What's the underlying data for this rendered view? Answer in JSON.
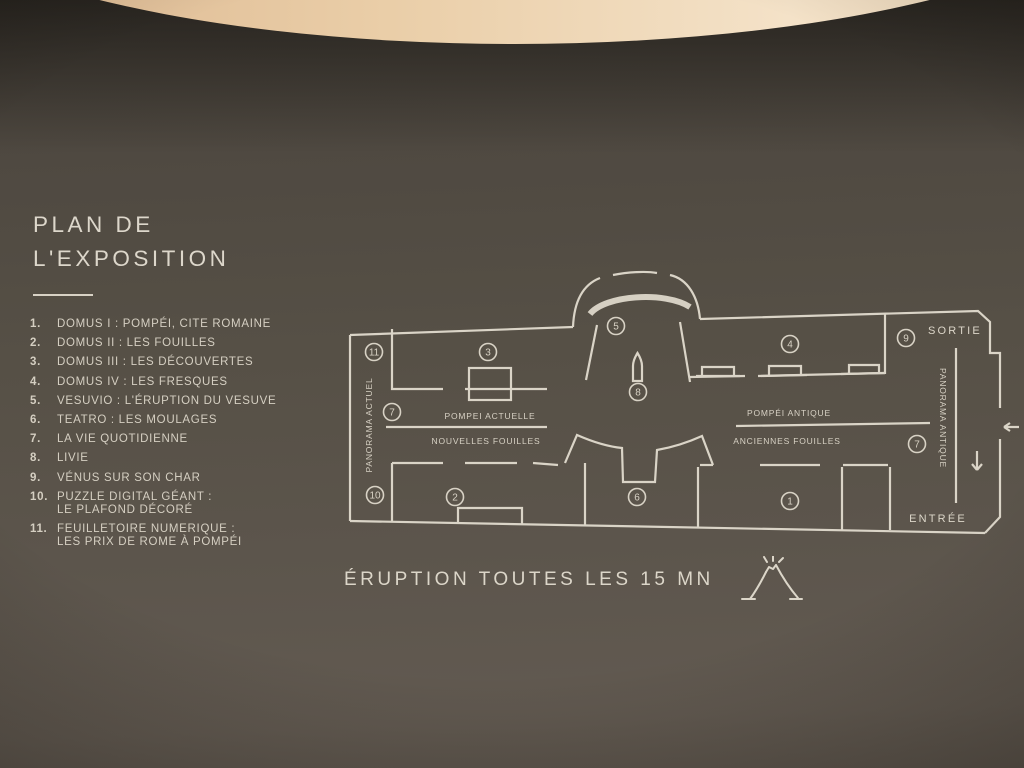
{
  "colors": {
    "wall": "#57504a",
    "text": "#d8d2c5",
    "ceiling": "#eed7ba",
    "line": "#dad4c7"
  },
  "title": {
    "line1": "PLAN DE",
    "line2": "L'EXPOSITION"
  },
  "legend": {
    "items": [
      {
        "num": "1.",
        "text": "DOMUS I : POMPÉI, CITE ROMAINE"
      },
      {
        "num": "2.",
        "text": "DOMUS II : LES FOUILLES"
      },
      {
        "num": "3.",
        "text": "DOMUS III : LES DÉCOUVERTES"
      },
      {
        "num": "4.",
        "text": "DOMUS IV : LES FRESQUES"
      },
      {
        "num": "5.",
        "text": "VESUVIO : L'ÉRUPTION DU VESUVE"
      },
      {
        "num": "6.",
        "text": "TEATRO : LES MOULAGES"
      },
      {
        "num": "7.",
        "text": "LA VIE QUOTIDIENNE"
      },
      {
        "num": "8.",
        "text": "LIVIE"
      },
      {
        "num": "9.",
        "text": "VÉNUS SUR SON CHAR"
      },
      {
        "num": "10.",
        "text": "PUZZLE DIGITAL GÉANT :",
        "text2": "LE PLAFOND DÉCORÉ"
      },
      {
        "num": "11.",
        "text": "FEUILLETOIRE NUMERIQUE :",
        "text2": "LES PRIX DE ROME À POMPÉI"
      }
    ]
  },
  "plan": {
    "markers": {
      "m1": "1",
      "m2": "2",
      "m3": "3",
      "m4": "4",
      "m5": "5",
      "m6": "6",
      "m7": "7",
      "m7b": "7",
      "m8": "8",
      "m9": "9",
      "m10": "10",
      "m11": "11"
    },
    "labels": {
      "panorama_actuel": "PANORAMA ACTUEL",
      "pompei_actuelle": "POMPEI ACTUELLE",
      "nouvelles_fouilles": "NOUVELLES FOUILLES",
      "pompei_antique": "POMPÉI ANTIQUE",
      "anciennes_fouilles": "ANCIENNES FOUILLES",
      "panorama_antique": "PANORAMA ANTIQUE",
      "sortie": "SORTIE",
      "entree": "ENTRÉE"
    }
  },
  "footer": {
    "text": "ÉRUPTION TOUTES LES 15 MN"
  }
}
